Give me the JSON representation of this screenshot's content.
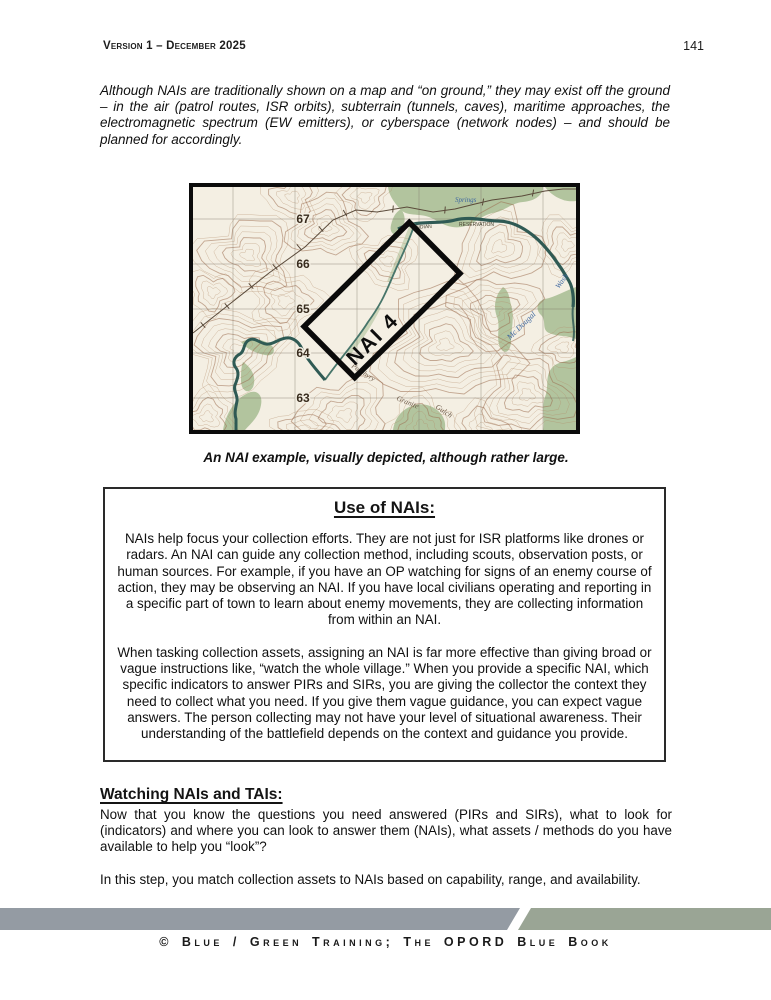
{
  "header": {
    "version": "Version 1 – December 2025",
    "page_number": "141"
  },
  "intro_paragraph": "Although NAIs are traditionally shown on a map and “on ground,” they may exist off the ground – in the air (patrol routes, ISR orbits), subterrain (tunnels, caves), maritime approaches, the electromagnetic spectrum (EW emitters), or cyberspace (network nodes) – and should be planned for accordingly.",
  "figure": {
    "caption": "An NAI example, visually depicted, although rather large.",
    "map": {
      "nai_label": "NAI 4",
      "grid_numbers": [
        "67",
        "66",
        "65",
        "64",
        "63"
      ],
      "labels": {
        "springs": "Springs",
        "indian": "INDIAN",
        "reservation": "RESERVATION",
        "mc_dougal": "Mc Dougal",
        "wash": "Wash",
        "porphyry": "Porphyry",
        "granite": "Granite",
        "gulch": "Gulch"
      }
    }
  },
  "use_of_nais_box": {
    "title": "Use of NAIs:",
    "paragraph_1": "NAIs help focus your collection efforts. They are not just for ISR platforms like drones or radars. An NAI can guide any collection method, including scouts, observation posts, or human sources. For example, if you have an OP watching for signs of an enemy course of action, they may be observing an NAI. If you have local civilians operating and reporting in a specific part of town to learn about enemy movements, they are collecting information from within an NAI.",
    "paragraph_2": "When tasking collection assets, assigning an NAI is far more effective than giving broad or vague instructions like, “watch the whole village.” When you provide a specific NAI, which specific indicators to answer PIRs and SIRs, you are giving the collector the context they need to collect what you need. If you give them vague guidance, you can expect vague answers. The person collecting may not have your level of situational awareness. Their understanding of the battlefield depends on the context and guidance you provide."
  },
  "watching_section": {
    "title": "Watching NAIs and TAIs:",
    "paragraph_1": "Now that you know the questions you need answered (PIRs and SIRs), what to look for (indicators) and where you can look to answer them (NAIs), what assets / methods do you have available to help you “look”?",
    "paragraph_2": "In this step, you match collection assets to NAIs based on capability, range, and availability."
  },
  "footer": {
    "credit": "© Blue / Green Training; The OPORD Blue Book"
  },
  "colors": {
    "footer_gray": "#949BA3",
    "footer_sage": "#9AA595",
    "map_paper": "#F4EFE3",
    "map_contour": "#AD8262",
    "map_water": "#2F5A54",
    "map_vegetation": "#B2C49E",
    "nai_outline": "#0A0A0A"
  }
}
